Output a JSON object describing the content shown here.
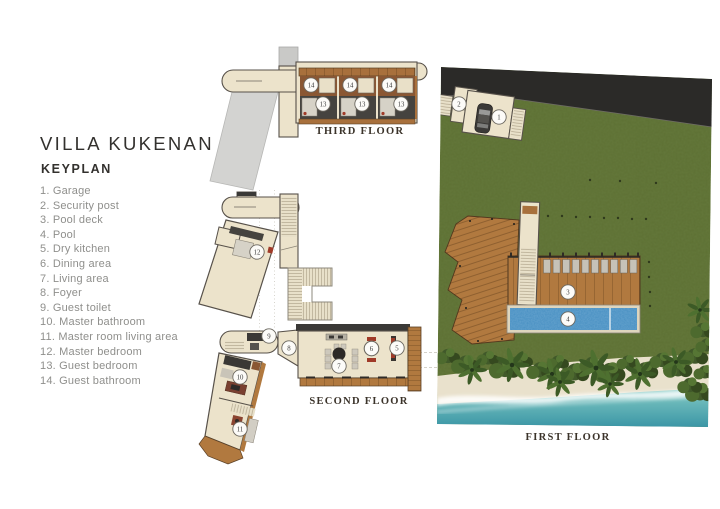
{
  "title": "VILLA KUKENAN",
  "subtitle": "KEYPLAN",
  "keyplan_items": [
    {
      "n": "1",
      "display": "1. Garage"
    },
    {
      "n": "2",
      "display": "2. Security post"
    },
    {
      "n": "3",
      "display": "3. Pool deck"
    },
    {
      "n": "4",
      "display": "4. Pool"
    },
    {
      "n": "5",
      "display": "5. Dry kitchen"
    },
    {
      "n": "6",
      "display": "6. Dining area"
    },
    {
      "n": "7",
      "display": "7. Living area"
    },
    {
      "n": "8",
      "display": "8. Foyer"
    },
    {
      "n": "9",
      "display": "9. Guest toilet"
    },
    {
      "n": "10",
      "display": "10. Master bathroom"
    },
    {
      "n": "11",
      "display": "11. Master room living area"
    },
    {
      "n": "12",
      "display": "12. Master bedroom"
    },
    {
      "n": "13",
      "display": "13. Guest bedroom"
    },
    {
      "n": "14",
      "display": "14. Guest bathroom"
    }
  ],
  "floors": {
    "third": {
      "label": "THIRD FLOOR"
    },
    "second": {
      "label": "SECOND FLOOR"
    },
    "first": {
      "label": "FIRST FLOOR"
    }
  },
  "colors": {
    "cream": "#ece3cb",
    "room_dark": "#45433f",
    "wood": "#a8703c",
    "wood_deck": "#b1793f",
    "gray_walkway": "#d3d3d1",
    "grass": "#5e7134",
    "road": "#2b2a28",
    "pool": "#478fc2",
    "sea": "#3e9aa9",
    "sand": "#e9e1cc",
    "accent_red": "#a03a28",
    "outline": "#57514a",
    "text_dark": "#33312e",
    "text_gray": "#8f8f8c",
    "label": "#3b332a"
  }
}
